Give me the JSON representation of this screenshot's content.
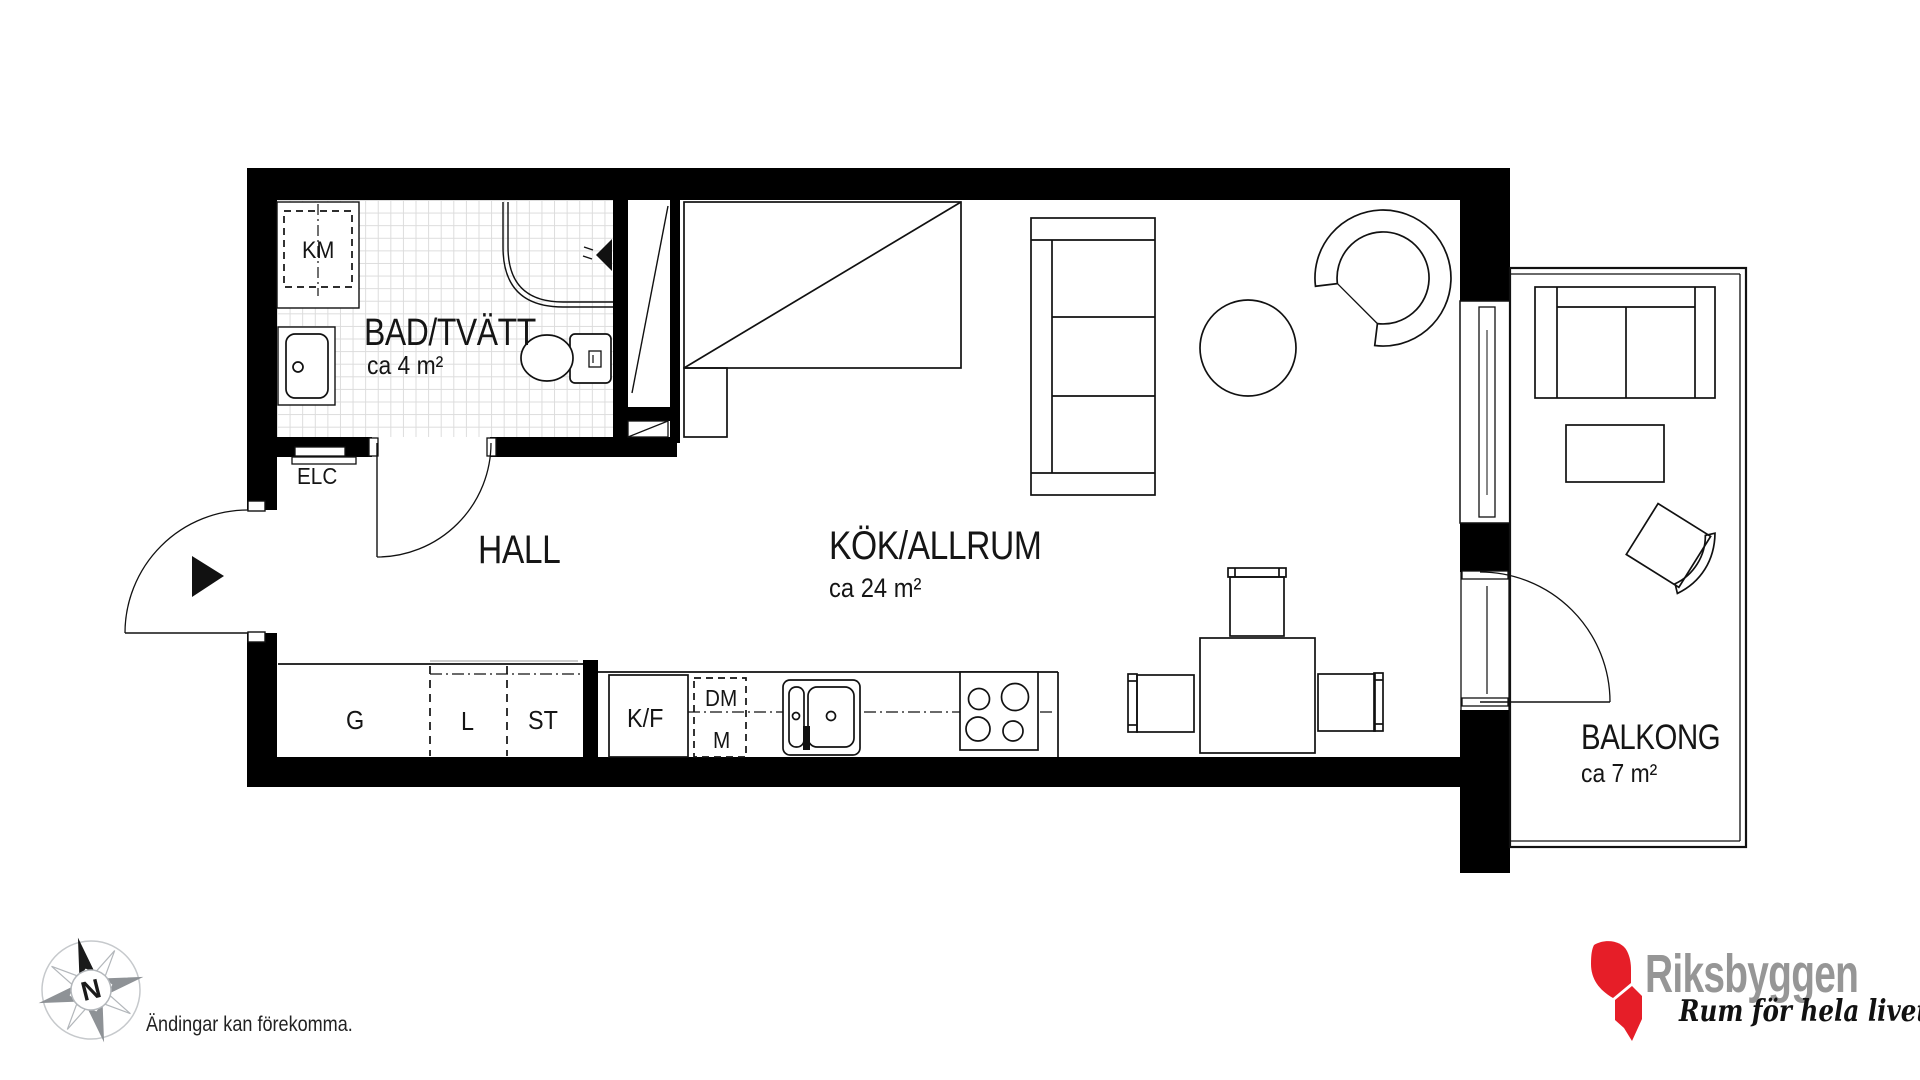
{
  "plan": {
    "rooms": [
      {
        "name": "BAD/TVÄTT",
        "area": "ca 4 m²"
      },
      {
        "name": "HALL",
        "area": ""
      },
      {
        "name": "KÖK/ALLRUM",
        "area": "ca 24 m²"
      },
      {
        "name": "BALKONG",
        "area": "ca 7 m²"
      }
    ],
    "fixtures": {
      "washing_machine": "KM",
      "electrical_cabinet": "ELC",
      "wardrobe": "G",
      "linen_closet": "L",
      "cleaning_closet": "ST",
      "fridge_freezer": "K/F",
      "dishwasher": "DM",
      "microwave": "M"
    }
  },
  "compass": {
    "north_label": "N"
  },
  "footer": {
    "disclaimer": "Ändingar kan förekomma."
  },
  "brand": {
    "name": "Riksbyggen",
    "tagline": "Rum för hela livet",
    "colors": {
      "red": "#e61e28",
      "gray": "#969696"
    }
  }
}
